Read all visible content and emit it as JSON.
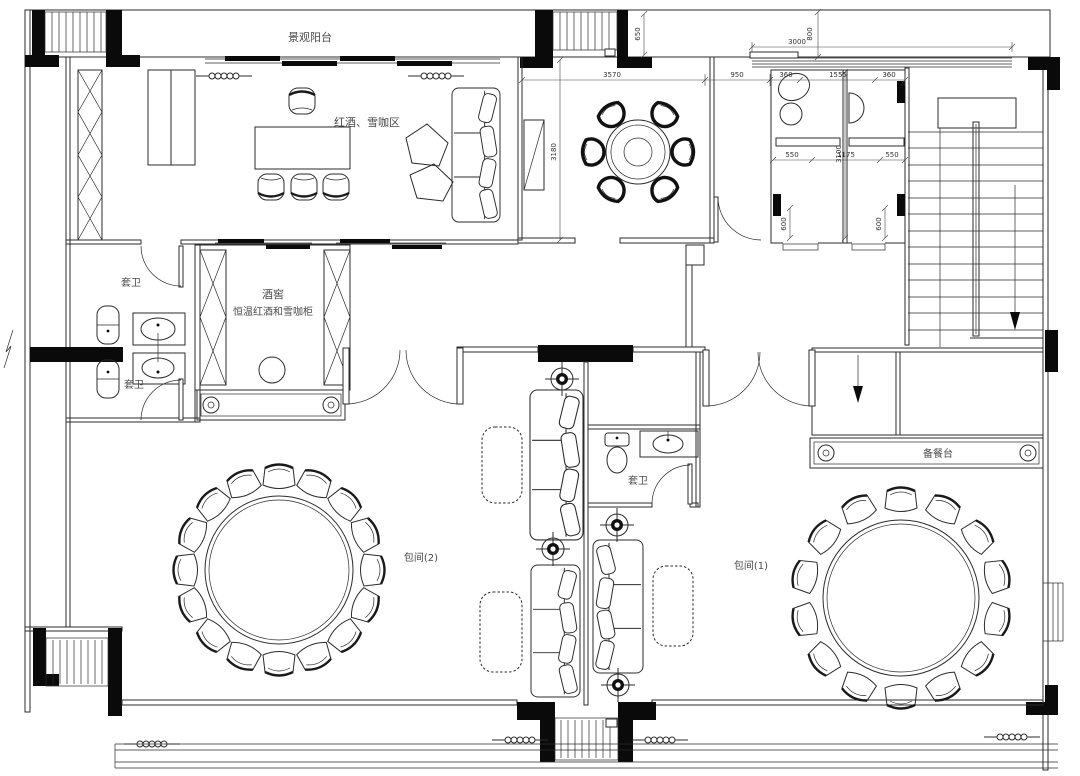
{
  "colors": {
    "ink": "#2b2b2b",
    "paper": "#ffffff"
  },
  "labels": {
    "balcony": "景观阳台",
    "wine_coffee_area": "红酒、雪咖区",
    "cellar_line1": "酒窖",
    "cellar_line2": "恒温红酒和雪咖柜",
    "ensuite_upper": "套卫",
    "ensuite_lower": "套卫",
    "ensuite_middle": "套卫",
    "private_room_2": "包间(2)",
    "private_room_1": "包间(1)",
    "serving_counter": "备餐台"
  },
  "dimensions": {
    "top_width": "3000",
    "top_depth": "800",
    "balcony_depth": "650",
    "dining_width": "3570",
    "corridor_width": "950",
    "wc_a": "360",
    "wc_width": "1555",
    "wc_b": "360",
    "dining_depth": "3180",
    "wc_inner_a": "550",
    "wc_depth": "3100",
    "wc_inner_mid": "1175",
    "wc_inner_b": "550",
    "fixture_a": "600",
    "fixture_b": "600"
  }
}
